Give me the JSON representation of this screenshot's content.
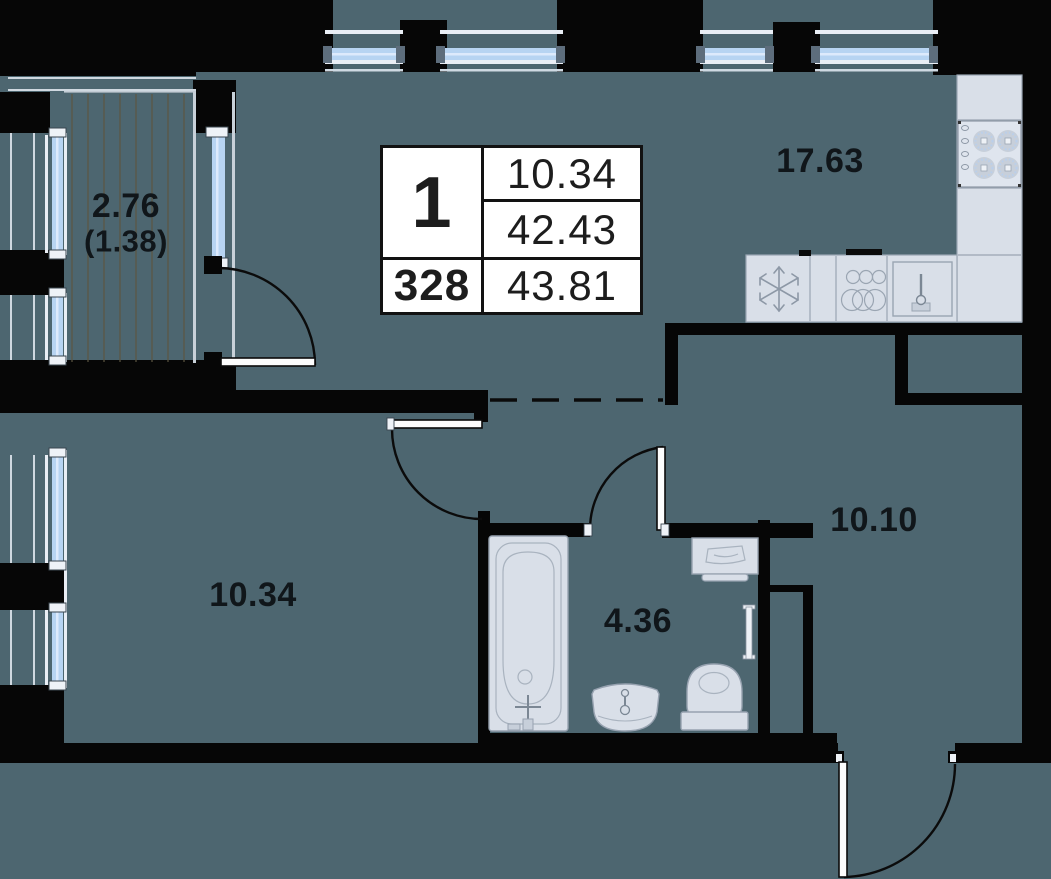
{
  "labels": {
    "balcony": "2.76",
    "balcony_coeff": "(1.38)",
    "kitchen_living": "17.63",
    "bedroom": "10.34",
    "bathroom": "4.36",
    "hallway": "10.10"
  },
  "table": {
    "rooms": "1",
    "living_area": "10.34",
    "area_no_balcony": "42.43",
    "unit": "328",
    "total_area": "43.81"
  },
  "colors": {
    "floor": "#4d6670",
    "walls": "#060606",
    "window_glass": "#b7d4f2",
    "window_frame": "#e9eef5",
    "fixtures": "#d9dfe8",
    "fixture_stroke": "#97a2b0"
  },
  "fixtures": {
    "kitchen": [
      "fridge-snowflake-icon",
      "hob-burners-icon",
      "sink-icon",
      "cabinet-circles-icon"
    ],
    "bathroom": [
      "bathtub-icon",
      "washbasin-icon",
      "toilet-icon",
      "washer-icon",
      "towel-rail-icon"
    ]
  }
}
